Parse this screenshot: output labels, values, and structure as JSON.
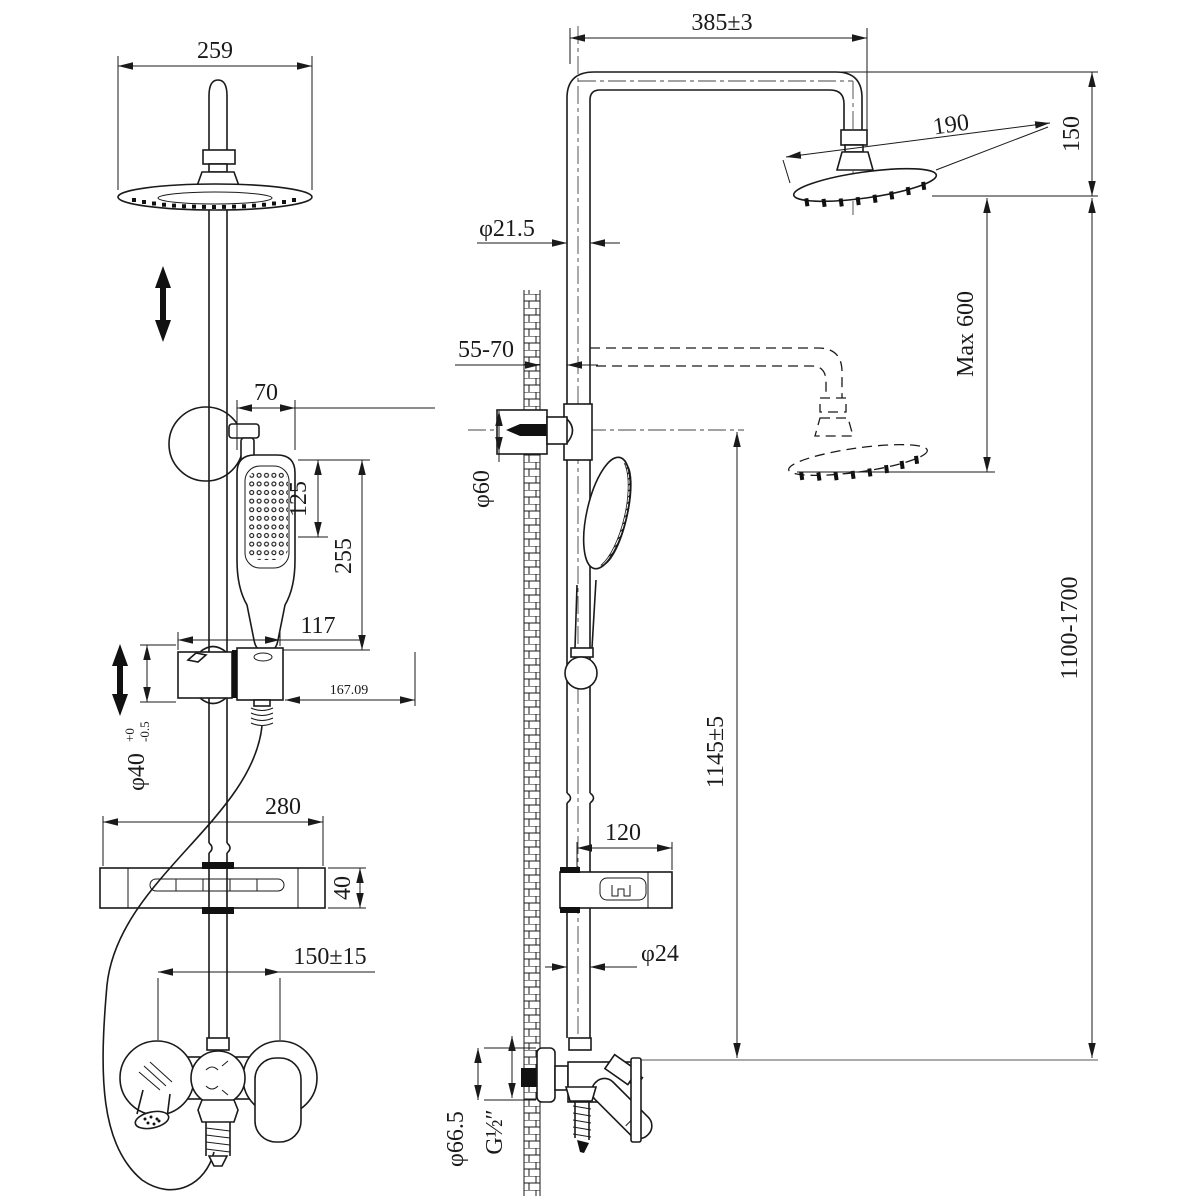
{
  "drawing": {
    "title": "Shower column system — dimensional drawing",
    "line_color": "#1a1a1a",
    "background": "#ffffff"
  },
  "front_view": {
    "label": "front view",
    "dims": {
      "head_width": "259",
      "hand_width": "70",
      "hand_face": "125",
      "hand_length": "255",
      "slider_width": "117",
      "slider_offset": "167.09",
      "column_dia": "φ40",
      "column_tol_up": "+0",
      "column_tol_low": "-0.5",
      "shelf_width": "280",
      "shelf_thickness": "40",
      "inlet_spacing": "150±15"
    }
  },
  "side_view": {
    "label": "side view",
    "dims": {
      "arm_reach": "385±3",
      "head_dia": "190",
      "head_drop": "150",
      "max_adjust": "Max 600",
      "pipe_dia_top": "φ21.5",
      "wall_gap": "55-70",
      "bracket_dia": "φ60",
      "inlet_height": "1145±5",
      "shelf_depth": "120",
      "pipe_dia_bottom": "φ24",
      "valve_dia": "φ66.5",
      "thread": "G½″",
      "overall_height": "1100-1700"
    }
  }
}
